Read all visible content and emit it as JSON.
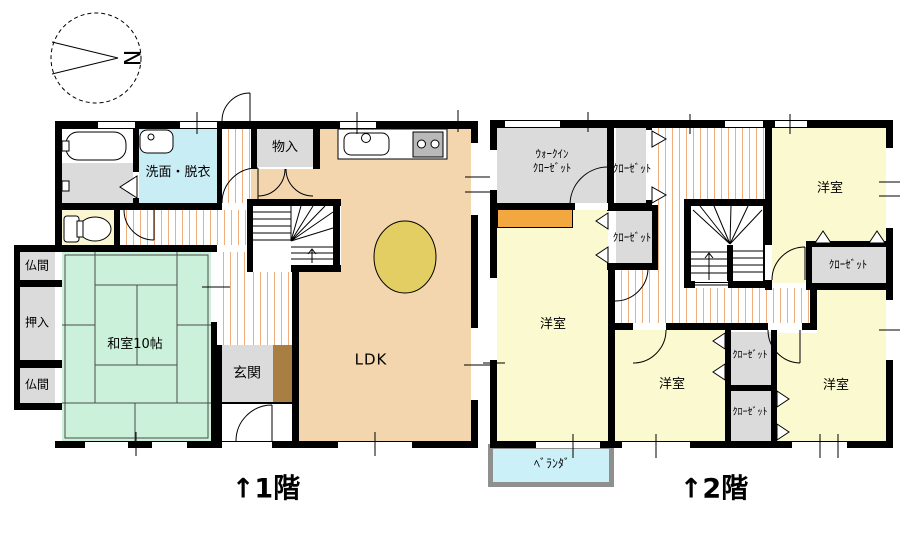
{
  "compass": {
    "letter": "N"
  },
  "floor1": {
    "caption": "↑1階",
    "rooms": {
      "washroom": "洗面・脱衣",
      "storage": "物入",
      "altar1": "仏間",
      "oshiire": "押入",
      "altar2": "仏間",
      "tatami": "和室10帖",
      "entrance": "玄関",
      "ldk": "LDK"
    }
  },
  "floor2": {
    "caption": "↑2階",
    "rooms": {
      "wic_line1": "ｳｫｰｸｲﾝ",
      "wic_line2": "ｸﾛｰｾﾞｯﾄ",
      "closet_hall_upper": "ｸﾛｰｾﾞｯﾄ",
      "closet_hall_lower": "ｸﾛｰｾﾞｯﾄ",
      "closet_northeast": "ｸﾛｰｾﾞｯﾄ",
      "closet_mid_upper": "ｸﾛｰｾﾞｯﾄ",
      "closet_mid_lower": "ｸﾛｰｾﾞｯﾄ",
      "bedroom_ne": "洋室",
      "bedroom_w": "洋室",
      "bedroom_s": "洋室",
      "bedroom_se": "洋室",
      "veranda": "ﾍﾞﾗﾝﾀﾞ"
    }
  },
  "colors": {
    "wall": "#000000",
    "ldk": "#F4D6AE",
    "tatami": "#CBF1DA",
    "wet": "#C9EDF5",
    "toiletroom": "#FAF6D2",
    "gray": "#DBDBDB",
    "wood": "#EFAE7C",
    "yoshitsu": "#FAF9CF",
    "veranda": "#CBF0F8",
    "verandaborder": "#8F8F8F",
    "orange": "#F3A83F",
    "table": "#E3CE63",
    "brown": "#A87E42"
  }
}
